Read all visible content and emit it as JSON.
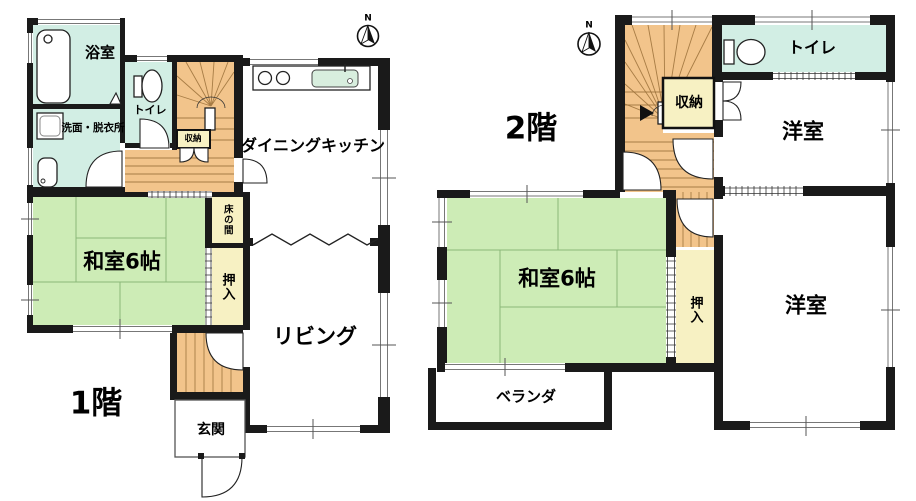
{
  "title": "間取り図",
  "colors": {
    "wall": "#1a1a1a",
    "water_cyan": "#d2eee4",
    "tatami_green": "#cdecb6",
    "wood_orange": "#f2c48b",
    "closet_cream": "#f7f1c3",
    "sink_green": "#d8eede",
    "bg": "#ffffff"
  },
  "compass": {
    "label": "N"
  },
  "floors": [
    {
      "label": "1階",
      "rooms": [
        {
          "label": "浴室"
        },
        {
          "label": "トイレ"
        },
        {
          "label": "洗面・脱衣所"
        },
        {
          "label": "収納"
        },
        {
          "label": "ダイニングキッチン"
        },
        {
          "label": "床の間"
        },
        {
          "label": "和室6帖"
        },
        {
          "label": "押入"
        },
        {
          "label": "リビング"
        },
        {
          "label": "玄関"
        }
      ]
    },
    {
      "label": "2階",
      "rooms": [
        {
          "label": "収納"
        },
        {
          "label": "トイレ"
        },
        {
          "label": "洋室"
        },
        {
          "label": "和室6帖"
        },
        {
          "label": "押入"
        },
        {
          "label": "洋室"
        },
        {
          "label": "ベランダ"
        }
      ]
    }
  ]
}
